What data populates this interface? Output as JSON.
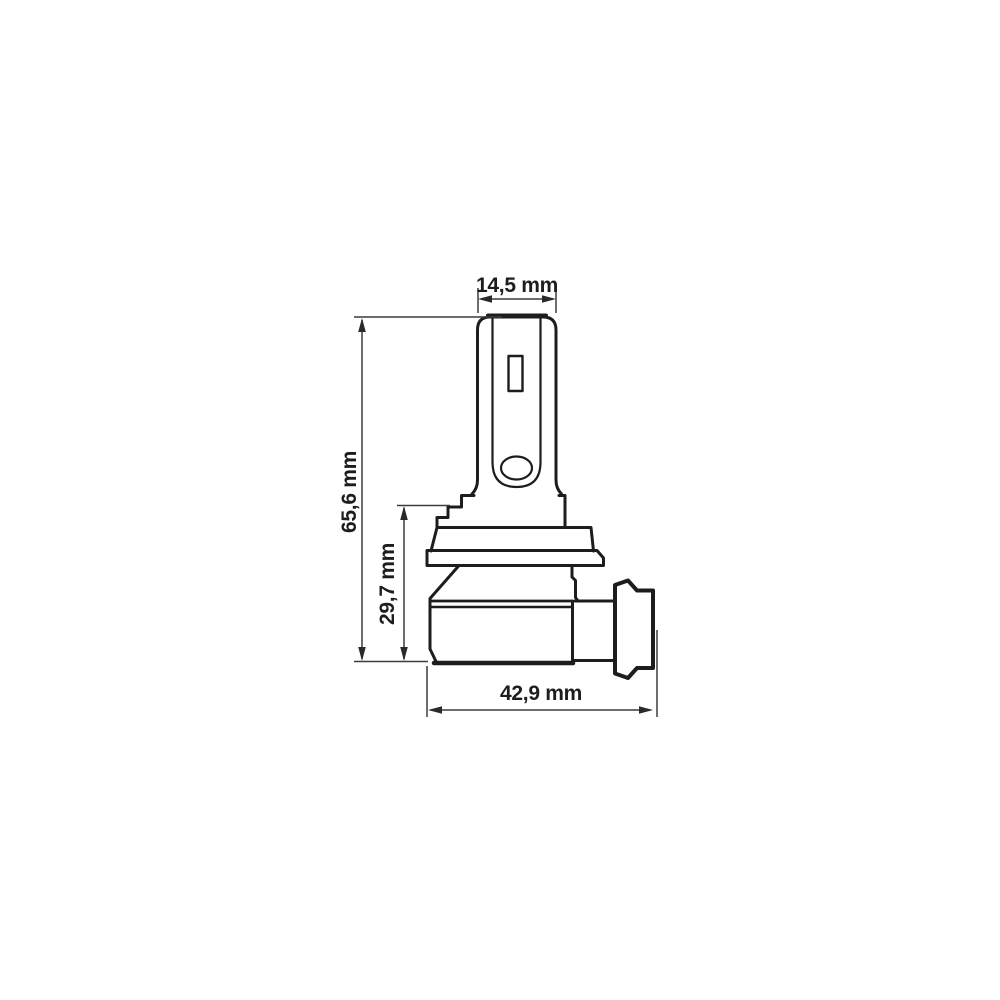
{
  "diagram": {
    "kind": "technical-dimension-drawing",
    "subject": "led-headlight-bulb-side-view",
    "background_color": "#ffffff",
    "outline_color": "#1d1d1b",
    "dimension_line_color": "#3c3c3a",
    "text_color": "#1d1d1b",
    "dimensions": {
      "top_width": {
        "label": "14,5 mm",
        "orientation": "horizontal"
      },
      "total_height": {
        "label": "65,6 mm",
        "orientation": "vertical"
      },
      "base_height": {
        "label": "29,7 mm",
        "orientation": "vertical"
      },
      "base_width": {
        "label": "42,9 mm",
        "orientation": "horizontal"
      }
    }
  }
}
